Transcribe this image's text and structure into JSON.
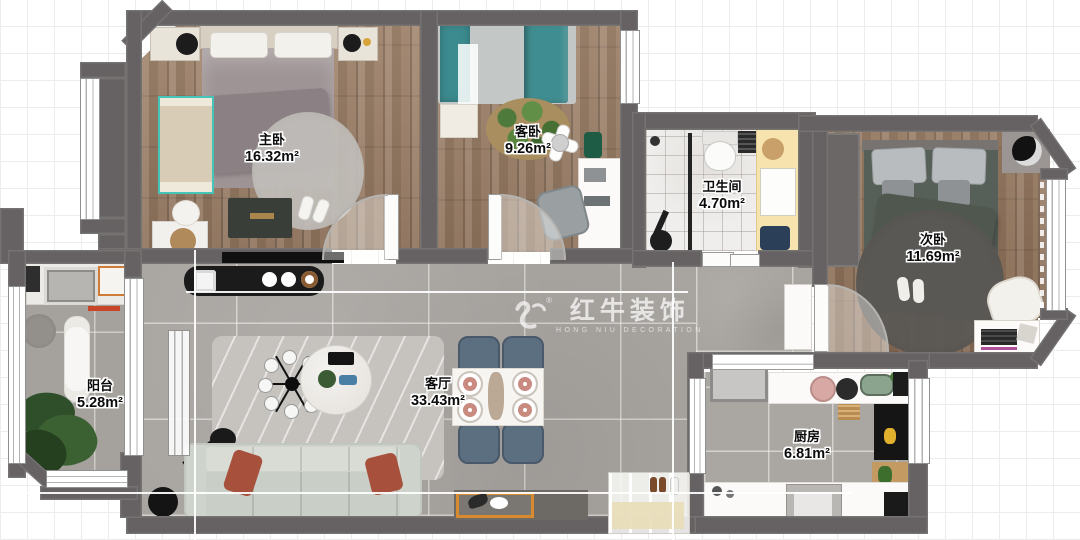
{
  "rooms": [
    {
      "id": "master-bedroom",
      "name": "主卧",
      "area": "16.32m²"
    },
    {
      "id": "guest-bedroom",
      "name": "客卧",
      "area": "9.26m²"
    },
    {
      "id": "bathroom",
      "name": "卫生间",
      "area": "4.70m²"
    },
    {
      "id": "second-bedroom",
      "name": "次卧",
      "area": "11.69m²"
    },
    {
      "id": "balcony",
      "name": "阳台",
      "area": "5.28m²"
    },
    {
      "id": "living-room",
      "name": "客厅",
      "area": "33.43m²"
    },
    {
      "id": "kitchen",
      "name": "厨房",
      "area": "6.81m²"
    }
  ],
  "watermark": {
    "logo": "bull-logo-icon",
    "registered": "®",
    "title": "红牛装饰",
    "subtitle": "HONG NIU DECORATION"
  },
  "colors": {
    "wall": "#666263",
    "wood_floor": "#9a7d64",
    "tile_floor": "#a8a4a0",
    "marble_floor": "#f0eeec",
    "teal_accent": "#3c8b8f",
    "vanity_yellow": "#f6e3ad",
    "pillow_red": "#a7503c",
    "dining_chair_blue": "#5b6f80",
    "sofa_gray_green": "#ced3cc"
  }
}
